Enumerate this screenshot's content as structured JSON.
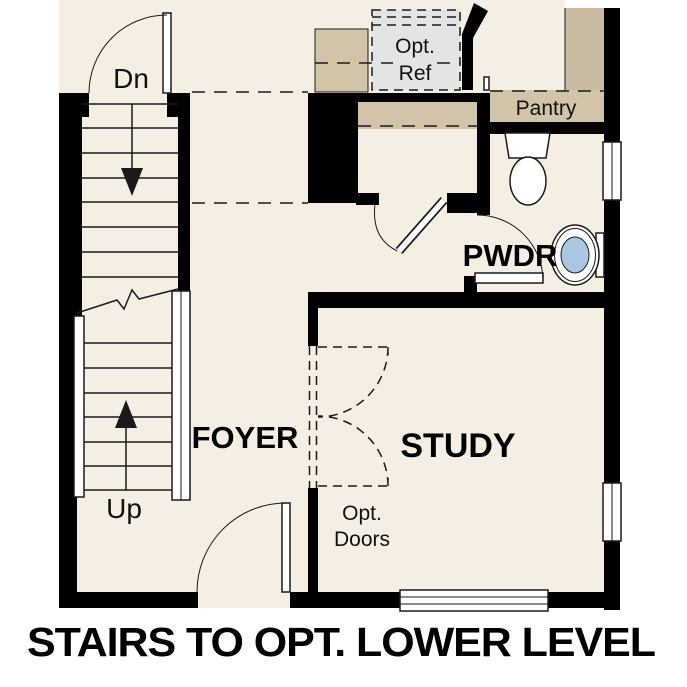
{
  "caption": "STAIRS TO OPT. LOWER LEVEL",
  "rooms": {
    "foyer": "FOYER",
    "study": "STUDY",
    "powder": "PWDR",
    "pantry": "Pantry"
  },
  "stairs": {
    "down_label": "Dn",
    "up_label": "Up"
  },
  "options": {
    "ref_line1": "Opt.",
    "ref_line2": "Ref",
    "doors_line1": "Opt.",
    "doors_line2": "Doors"
  },
  "colors": {
    "floor": "#f5eee3",
    "wall": "#000000",
    "line": "#1a1a1a",
    "counter": "#d2c4a9",
    "counter_dark": "#c9bba1",
    "fridge": "#e3e4e4",
    "fixture_blue": "#a9c6e2"
  }
}
